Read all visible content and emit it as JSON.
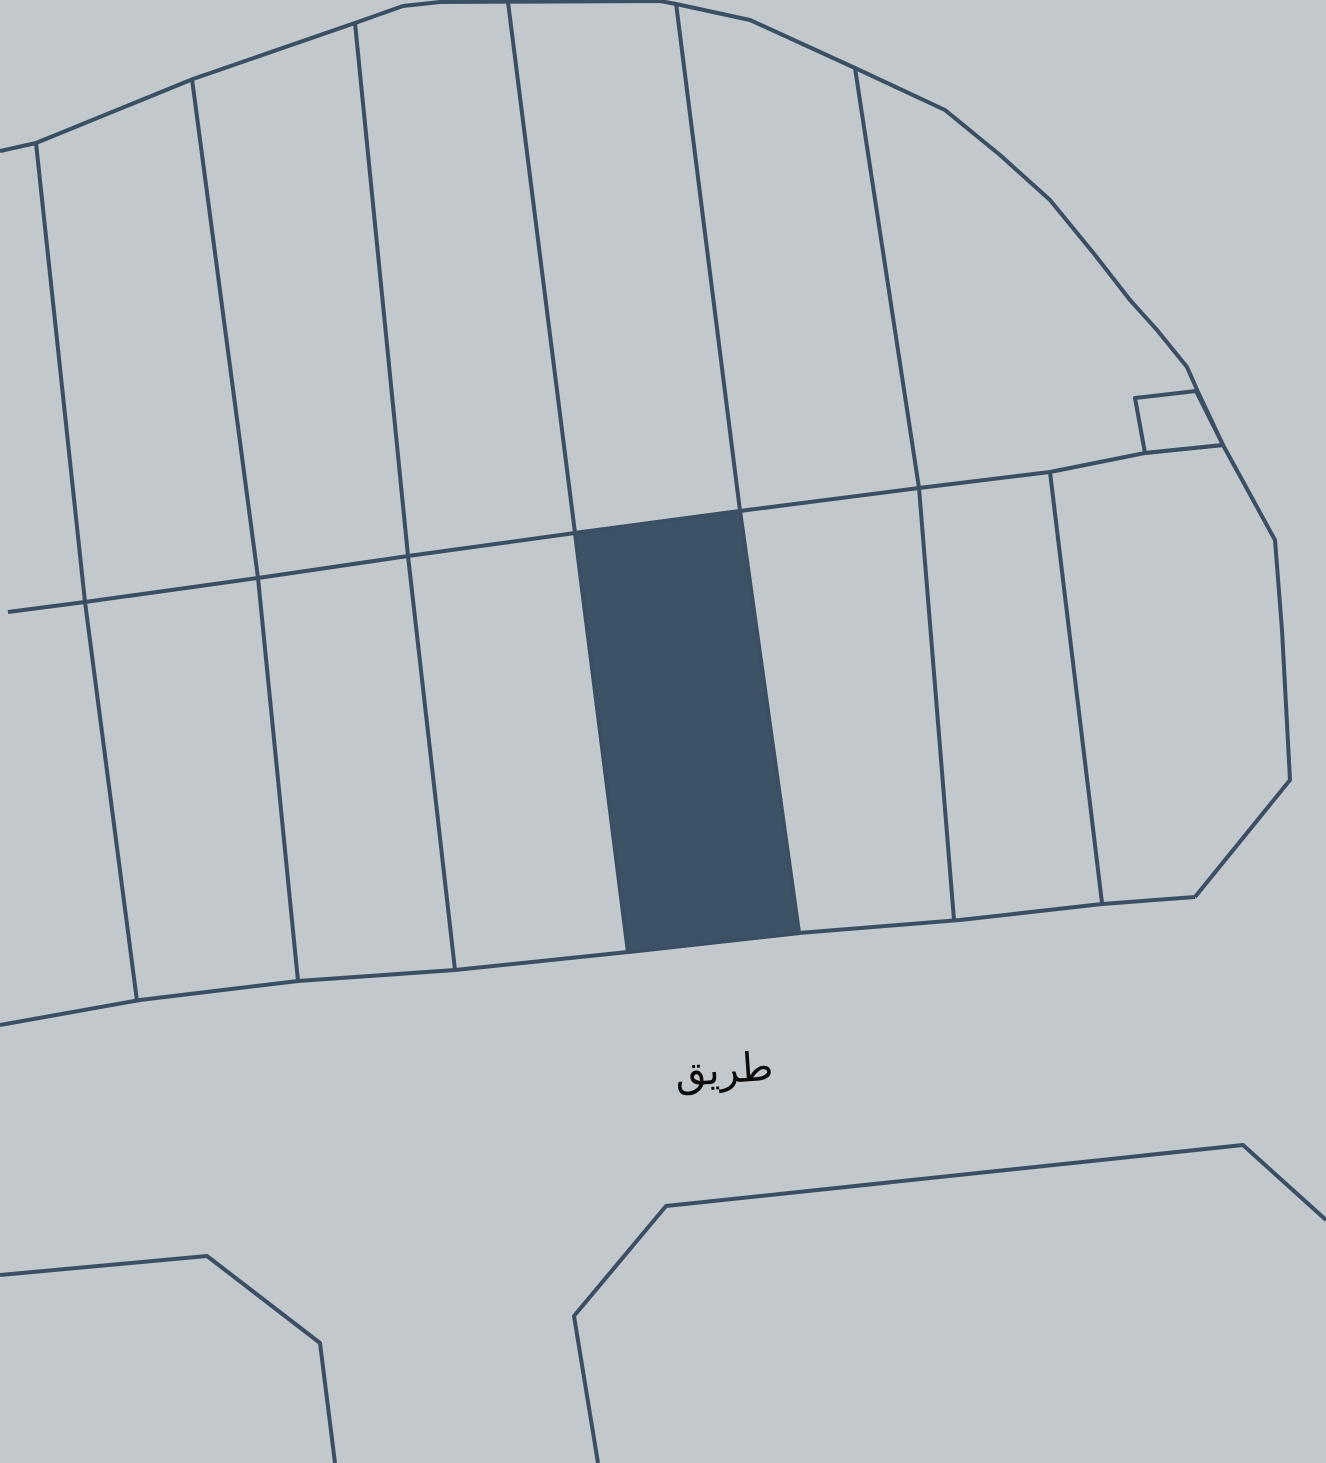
{
  "map": {
    "colors": {
      "background": "#c3c8cc",
      "line": "#3a4f63",
      "selected_parcel_fill": "#3e5266",
      "label": "#0b0b0b"
    },
    "road_label": {
      "text": "طريق"
    },
    "shapes": {
      "block_boundary": "0,151 36,143 193,79 355,23 403,6 440,2 660,1 676,4 750,20 855,68 945,110 1000,155 1050,200 1095,255 1130,300 1157,330 1187,367 1198,392 1223,445 1275,540 1282,630 1290,780 1195,897",
      "road_edge": "1195,897 1102,904 960,920 799,933 628,952 455,970 298,981 140,1000 0,1025",
      "mid_line": "8,612 85,602 258,578 408,556 575,533 740,511 919,488 1050,472 1145,453 1223,445",
      "divider_1": "36,143 85,602 137,1001",
      "divider_2": "192,79 258,578 298,981",
      "divider_3": "355,23 408,556 455,970",
      "divider_4": "508,2 575,533 628,952",
      "divider_5": "676,3 740,511 799,933",
      "divider_6": "855,68 919,488 954,920",
      "divider_7": "1050,472 1102,903",
      "notch_parcel": "1135,398 1196,391 1223,445 1145,453",
      "selected_parcel": "575,533 740,511 799,933 628,952",
      "bottom_left_parcel": "0,1275 207,1256 320,1343 335,1463",
      "bottom_right_parcel": "598,1463 574,1316 666,1206 1243,1145 1326,1220"
    }
  }
}
